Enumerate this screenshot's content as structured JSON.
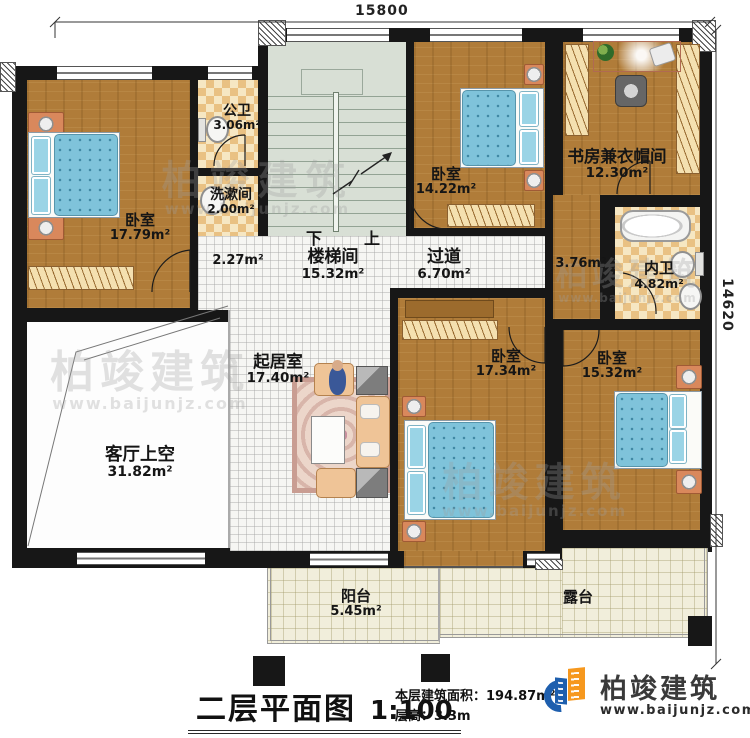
{
  "title_block": {
    "title": "二层平面图",
    "scale": "1:100",
    "area_line": "本层建筑面积：194.87m²",
    "height_line": "层高：3.3m"
  },
  "dimensions": {
    "top": "15800",
    "right": "14620"
  },
  "stairs": {
    "down_label": "下",
    "up_label": "上"
  },
  "rooms": {
    "bedroom_tl": {
      "name": "卧室",
      "area": "17.79m²"
    },
    "public_bath": {
      "name": "公卫",
      "area": "3.06m²"
    },
    "washroom": {
      "name": "洗漱间",
      "area": "2.00m²"
    },
    "stairwell": {
      "name": "楼梯间",
      "area": "15.32m²"
    },
    "bedroom_tm": {
      "name": "卧室",
      "area": "14.22m²"
    },
    "study": {
      "name": "书房兼衣帽间",
      "area": "12.30m²"
    },
    "inner_bath": {
      "name": "内卫",
      "area": "4.82m²"
    },
    "corridor": {
      "name": "过道",
      "area": "6.70m²"
    },
    "living": {
      "name": "起居室",
      "area": "17.40m²"
    },
    "living_void": {
      "name": "客厅上空",
      "area": "31.82m²"
    },
    "bedroom_bm": {
      "name": "卧室",
      "area": "17.34m²"
    },
    "bedroom_br": {
      "name": "卧室",
      "area": "15.32m²"
    },
    "balcony": {
      "name": "阳台",
      "area": "5.45m²"
    },
    "terrace": {
      "name": "露台"
    }
  },
  "hall_areas": {
    "left": "2.27m²",
    "right": "3.76m²"
  },
  "watermark": {
    "brand": "柏竣建筑",
    "url": "www.baijunjz.com"
  },
  "logo": {
    "brand": "柏竣建筑",
    "url": "www.baijunjz.com"
  },
  "colors": {
    "logo_blue": "#1e5fae",
    "logo_orange": "#f6981e",
    "wood": "#b07c39",
    "bed_blue": "#7fc3da"
  }
}
